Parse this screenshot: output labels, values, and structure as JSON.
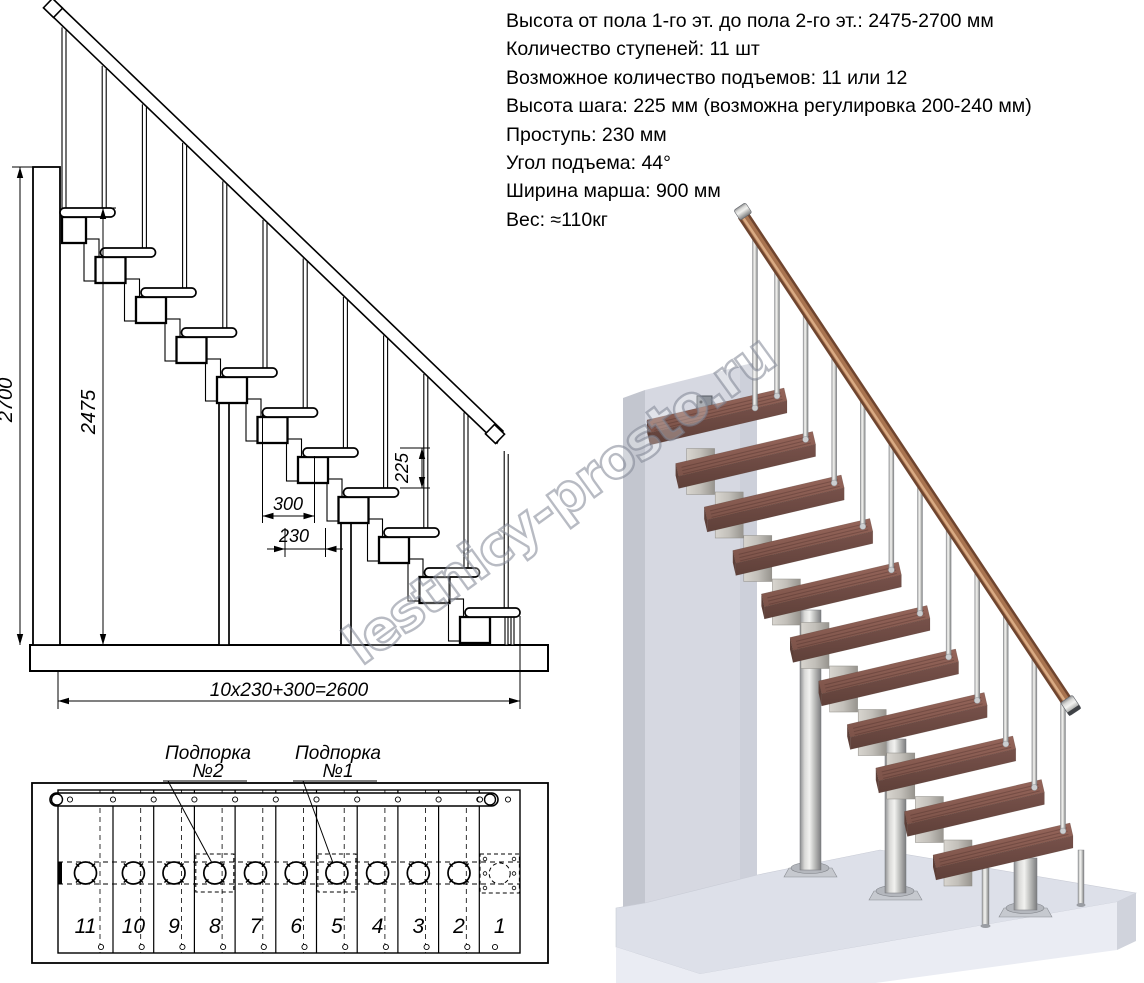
{
  "specs": {
    "lines": [
      "Высота от пола 1-го эт. до пола 2-го эт.: 2475-2700 мм",
      "Количество ступеней: 11 шт",
      "Возможное количество подъемов: 11 или 12",
      "Высота шага: 225 мм (возможна регулировка 200-240 мм)",
      "Проступь: 230 мм",
      "Угол подъема: 44°",
      "Ширина марша: 900 мм",
      "Вес: ≈110кг"
    ]
  },
  "side_view": {
    "dims": {
      "total_height": "2700",
      "stair_height": "2475",
      "riser": "225",
      "tread_depth": "300",
      "step_run": "230",
      "total_run": "10x230+300=2600"
    }
  },
  "plan_view": {
    "support_label_2": {
      "line1": "Подпорка",
      "line2": "№2"
    },
    "support_label_1": {
      "line1": "Подпорка",
      "line2": "№1"
    },
    "step_numbers": [
      "11",
      "10",
      "9",
      "8",
      "7",
      "6",
      "5",
      "4",
      "3",
      "2",
      "1"
    ]
  },
  "watermark": {
    "text": "lestnicy-prosto.ru"
  },
  "colors": {
    "line": "#000000",
    "tread_top_a": "#95655a",
    "tread_top_b": "#7c5349",
    "tread_front_a": "#77514a",
    "tread_front_b": "#5f4039",
    "tread_side": "#5d3f38",
    "wall_front": "#d6d8e1",
    "wall_side": "#c3c6cf",
    "floor_top": "#dde0e9",
    "floor_front": "#eaecf3",
    "handrail_dark": "#6f452f",
    "handrail_mid": "#a8734f",
    "handrail_light": "#d9ab84"
  }
}
